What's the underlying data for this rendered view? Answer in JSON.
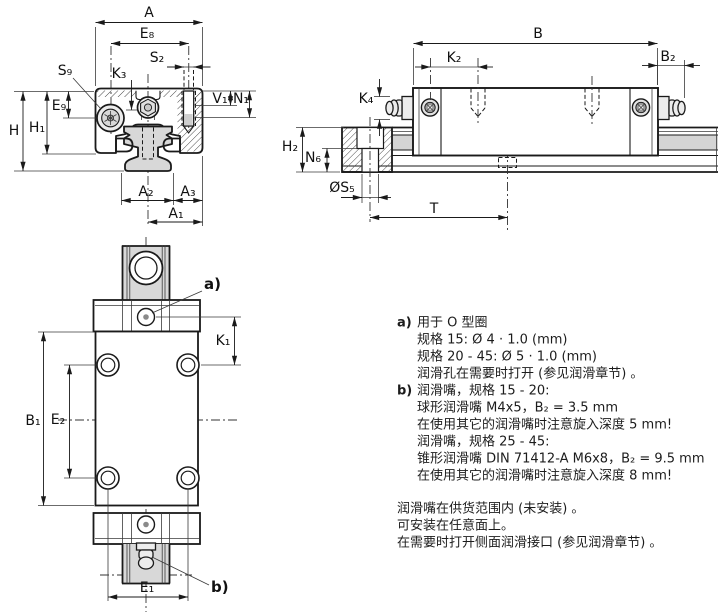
{
  "colors": {
    "line": "#1a1a1a",
    "part_gray": "#d8d8d8",
    "background": "#ffffff"
  },
  "dim_labels": {
    "A": "A",
    "E8": "E₈",
    "S2": "S₂",
    "S9": "S₉",
    "K3": "K₃",
    "V1": "V₁",
    "N1": "N₁",
    "H": "H",
    "H1": "H₁",
    "E9": "E₉",
    "A2": "A₂",
    "A3": "A₃",
    "A1": "A₁",
    "B": "B",
    "K2": "K₂",
    "B2": "B₂",
    "K4": "K₄",
    "H2": "H₂",
    "N6": "N₆",
    "S5": "ØS₅",
    "T": "T",
    "K1": "K₁",
    "B1": "B₁",
    "E2": "E₂",
    "E1": "E₁"
  },
  "callouts": {
    "a": "a)",
    "b": "b)"
  },
  "notes": {
    "a_marker": "a)",
    "a_lines": [
      "用于 O 型圈",
      "规格 15: Ø 4 · 1.0 (mm)",
      "规格 20 - 45: Ø 5 · 1.0 (mm)",
      "润滑孔在需要时打开 (参见润滑章节) 。"
    ],
    "b_marker": "b)",
    "b_lines": [
      "润滑嘴，规格 15 - 20:",
      "球形润滑嘴 M4x5，B₂ = 3.5 mm",
      "在使用其它的润滑嘴时注意旋入深度 5 mm!",
      "润滑嘴，规格 25 - 45:",
      "锥形润滑嘴 DIN 71412-A M6x8，B₂ = 9.5 mm",
      "在使用其它的润滑嘴时注意旋入深度 8 mm!"
    ],
    "footer_lines": [
      "润滑嘴在供货范围内 (未安装) 。",
      "可安装在任意面上。",
      "在需要时打开侧面润滑接口 (参见润滑章节) 。"
    ]
  }
}
